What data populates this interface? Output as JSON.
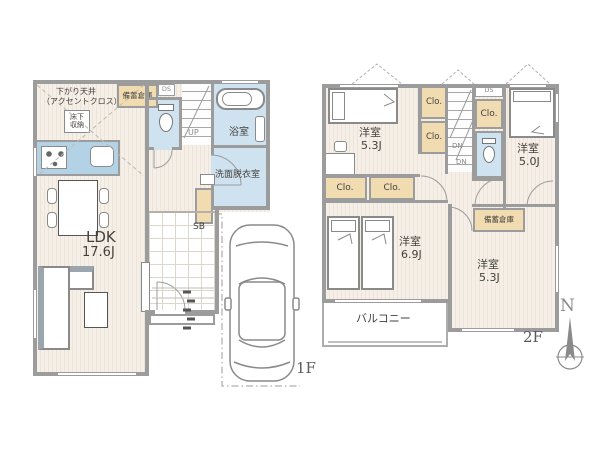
{
  "title": "戸建て間取り図（1F・2F）",
  "colors": {
    "wall": "#9c9c9c",
    "floor": "#f5efe8",
    "wet_area": "#cfe2ef",
    "closet": "#f1dcb2",
    "kitchen_counter": "#b4d2e6",
    "text": "#44413d"
  },
  "floor1": {
    "floor_label": "1F",
    "ldk_name": "LDK",
    "ldk_size": "17.6J",
    "lowered_ceiling_line1": "下がり天井",
    "lowered_ceiling_line2": "（アクセントクロス）",
    "underfloor_storage": "床下収納",
    "stockpile_storage": "備蓄倉庫",
    "duct_space": "DS",
    "bath": "浴室",
    "washroom": "洗面脱衣室",
    "stairs_label": "UP",
    "shoe_box": "SB"
  },
  "floor2": {
    "floor_label": "2F",
    "room_tl": {
      "name": "洋室",
      "size": "5.3J"
    },
    "room_tr": {
      "name": "洋室",
      "size": "5.0J"
    },
    "room_bl": {
      "name": "洋室",
      "size": "6.9J"
    },
    "room_br": {
      "name": "洋室",
      "size": "5.3J"
    },
    "closet": "Clo.",
    "duct_space": "DS",
    "stairs_label": "DN",
    "stockpile_storage": "備蓄倉庫",
    "balcony": "バルコニー",
    "compass_north": "N"
  }
}
